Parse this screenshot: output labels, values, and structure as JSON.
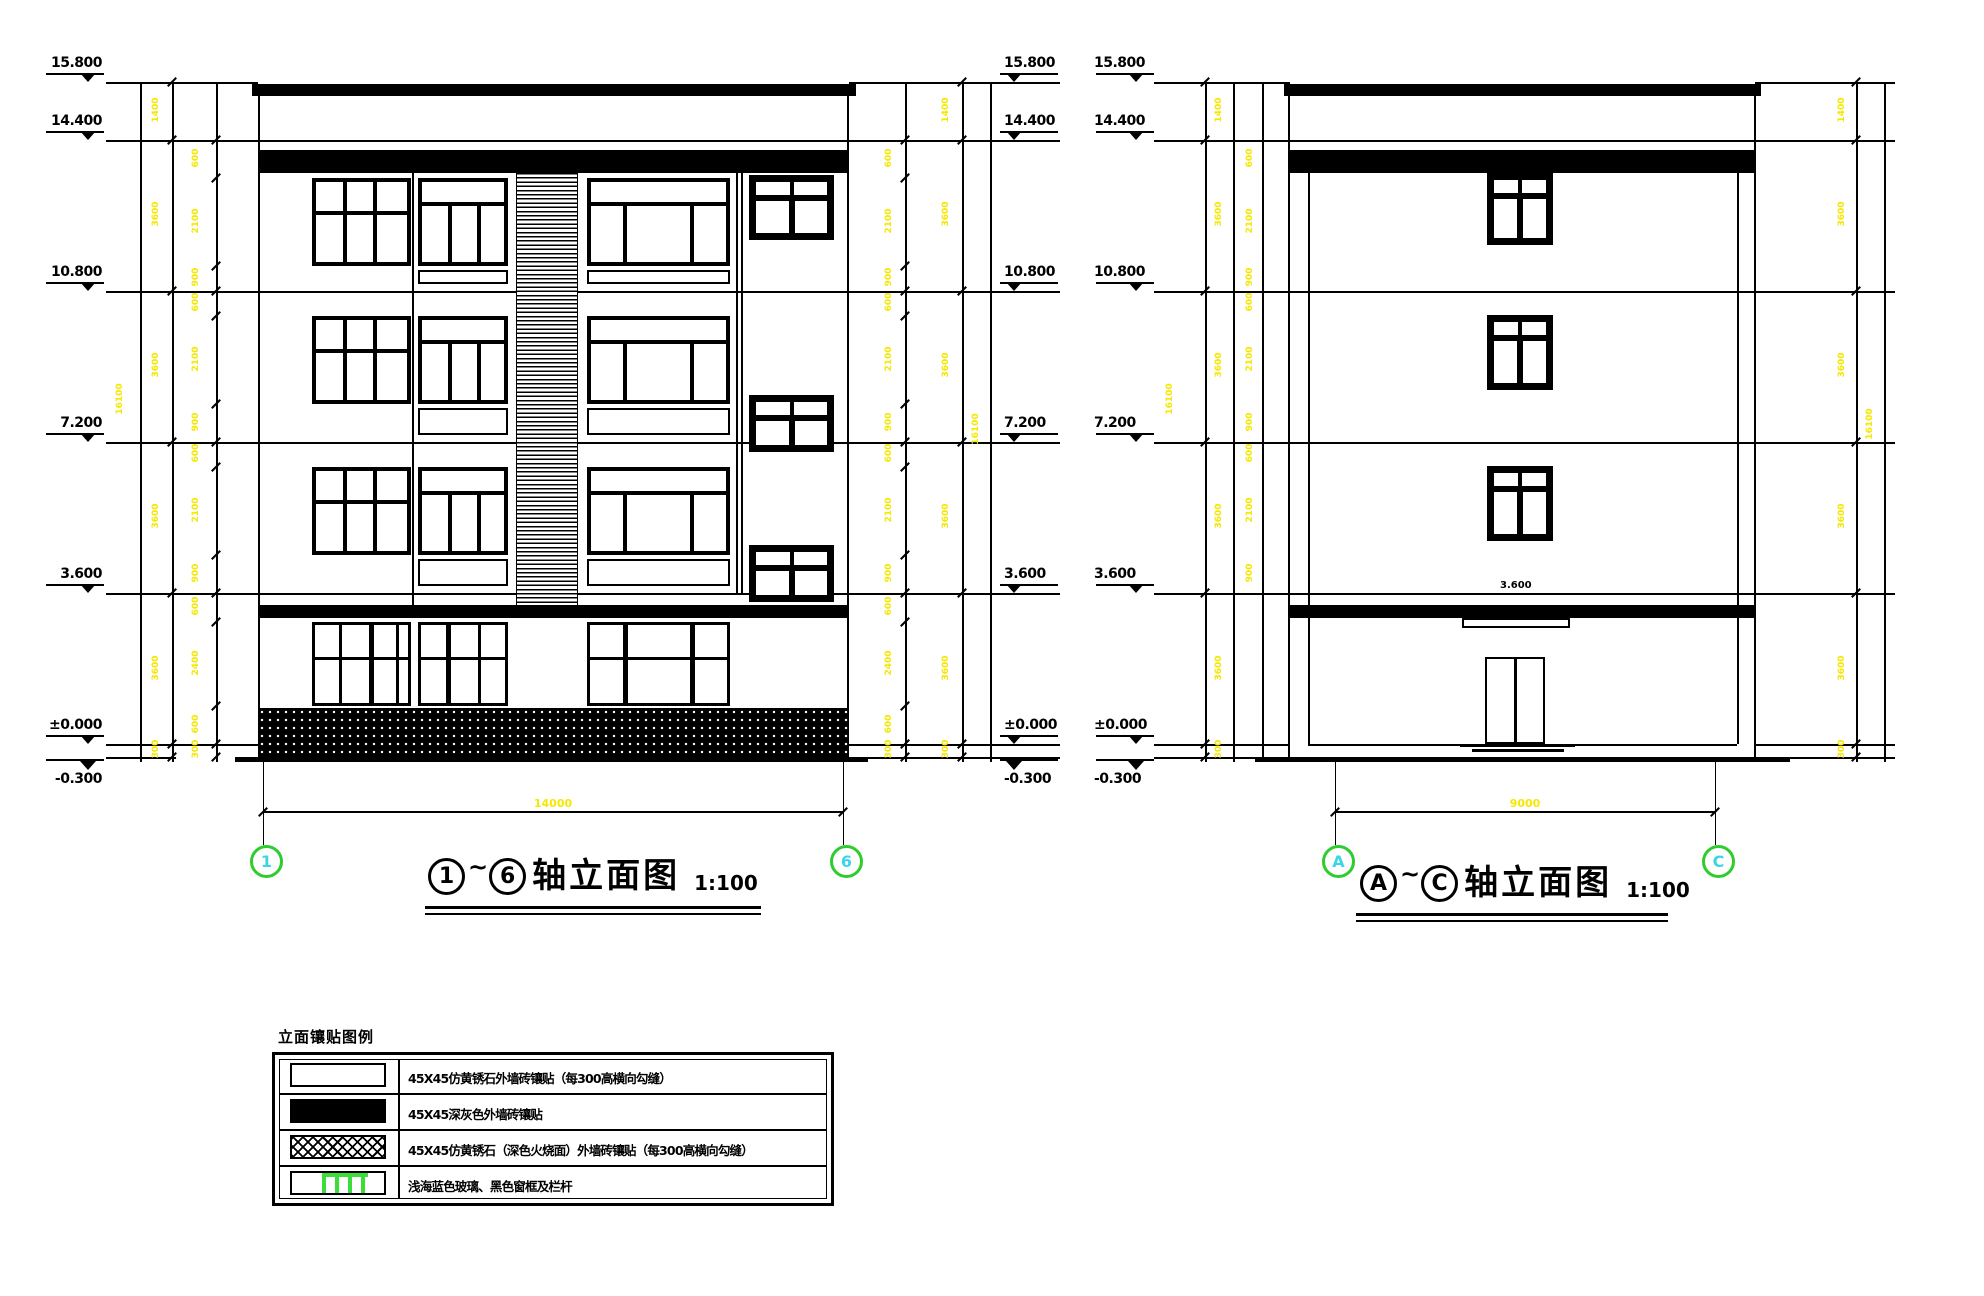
{
  "colors": {
    "line": "#000000",
    "dim_text_yellow": "#F5E800",
    "axis_circle_green": "#2FCC2F",
    "axis_text_cyan": "#3CD5E8",
    "legend_green": "#3ADD3A"
  },
  "levels": [
    "15.800",
    "14.400",
    "10.800",
    "7.200",
    "3.600",
    "±0.000",
    "-0.300"
  ],
  "dims": {
    "floor_heights": [
      "1400",
      "3600",
      "3600",
      "3600",
      "3600",
      "300"
    ],
    "window_heights": [
      "600",
      "2100",
      "900",
      "600",
      "2100",
      "900",
      "600",
      "2100",
      "900",
      "600",
      "2400",
      "600",
      "300"
    ],
    "overall_height": "16100",
    "left_total_width": "14000",
    "right_total_width": "9000",
    "canopy_level": "3.600"
  },
  "axes": {
    "a1": "1",
    "a6": "6",
    "aa": "A",
    "ac": "C"
  },
  "titles": {
    "left": {
      "from": "1",
      "tilde": "~",
      "to": "6",
      "label": "轴立面图",
      "scale": "1:100"
    },
    "right": {
      "from": "A",
      "tilde": "~",
      "to": "C",
      "label": "轴立面图",
      "scale": "1:100"
    }
  },
  "legend": {
    "title": "立面镶贴图例",
    "rows": [
      {
        "swatch": "white",
        "label": "45X45仿黄锈石外墙砖镶贴（每300高横向勾缝）"
      },
      {
        "swatch": "black",
        "label": "45X45深灰色外墙砖镶贴"
      },
      {
        "swatch": "crosshatch",
        "label": "45X45仿黄锈石（深色火烧面）外墙砖镶贴（每300高横向勾缝）"
      },
      {
        "swatch": "glass",
        "label": "浅海蓝色玻璃、黑色窗框及栏杆"
      }
    ]
  }
}
